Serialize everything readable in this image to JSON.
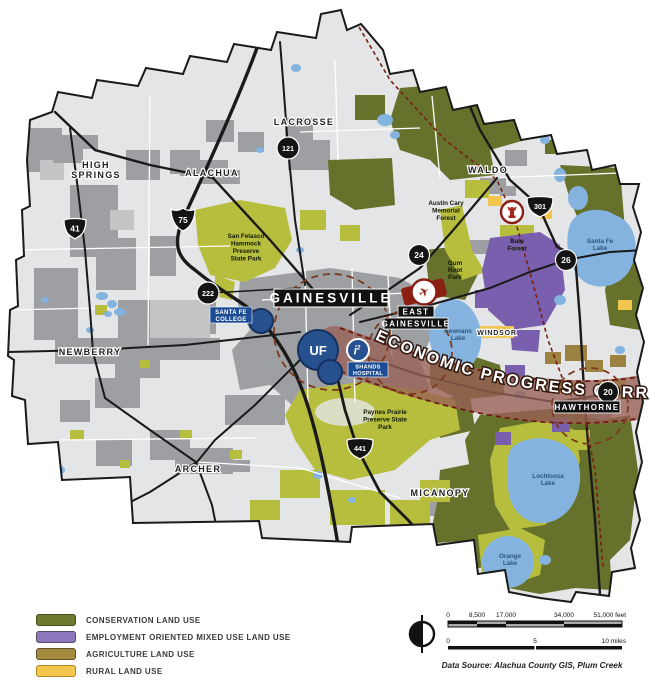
{
  "map": {
    "towns": {
      "high_springs": [
        "HIGH",
        "SPRINGS"
      ],
      "alachua": "ALACHUA",
      "lacrosse": "LACROSSE",
      "waldo": "WALDO",
      "newberry": "NEWBERRY",
      "archer": "ARCHER",
      "micanopy": "MICANOPY",
      "windsor": "WINDSOR"
    },
    "boxes": {
      "gainesville": "GAINESVILLE",
      "east_gainesville": [
        "EAST",
        "GAINESVILLE"
      ],
      "hawthorne": "HAWTHORNE"
    },
    "institutions": {
      "santa_fe_college": [
        "SANTA FE",
        "COLLEGE"
      ],
      "shands": [
        "SHANDS",
        "HOSPITAL"
      ],
      "uf": "UF",
      "innovation": "i",
      "innovation_sup": "2"
    },
    "routes": {
      "i75": "75",
      "us41": "41",
      "us441": "441",
      "us301": "301",
      "sr121": "121",
      "sr222": "222",
      "sr24": "24",
      "sr26": "26",
      "sr20": "20"
    },
    "parks": {
      "san_felasco": [
        "San Felasco",
        "Hammock",
        "Preserve",
        "State Park"
      ],
      "austin_cary": [
        "Austin Cary",
        "Memorial",
        "Forest"
      ],
      "balu": [
        "Balu",
        "Forest"
      ],
      "gum_root": [
        "Gum",
        "Root",
        "Park"
      ],
      "paynes_prairie": [
        "Paynes Prairie",
        "Preserve State",
        "Park"
      ]
    },
    "lakes": {
      "newnans": [
        "Newnans",
        "Lake"
      ],
      "santa_fe": [
        "Santa Fe",
        "Lake"
      ],
      "lochloosa": [
        "Lochloosa",
        "Lake"
      ],
      "orange": [
        "Orange",
        "Lake"
      ]
    },
    "corridor_label": "ECONOMIC PROGRESS CORRIDOR"
  },
  "icons": {
    "airplane_icon": "✈"
  },
  "legend": {
    "items": [
      {
        "label": "CONSERVATION LAND USE",
        "color": "#6b7a2e"
      },
      {
        "label": "EMPLOYMENT ORIENTED MIXED USE LAND USE",
        "color": "#8d78bd"
      },
      {
        "label": "AGRICULTURE LAND USE",
        "color": "#a58a3f"
      },
      {
        "label": "RURAL LAND USE",
        "color": "#f3c64d"
      }
    ]
  },
  "scale": {
    "feet_ticks": [
      "0",
      "8,500",
      "17,000",
      "34,000",
      "51,000 feet"
    ],
    "miles_ticks": [
      "0",
      "5",
      "10 miles"
    ]
  },
  "source": "Data Source: Alachua County GIS, Plum Creek",
  "colors": {
    "conservation": "#66722b",
    "conservation_light": "#b7be3e",
    "employment_mixed_use": "#7a5fae",
    "agriculture": "#9c8140",
    "rural": "#f2c54e",
    "urban_gray": "#9d9fa2",
    "water": "#83b3de",
    "corridor_band": "#996055",
    "corridor_dash": "#6e1a10",
    "institution_blue": "#27508f",
    "label_blue": "#1c4c94",
    "road_black": "#1a1a1a"
  }
}
